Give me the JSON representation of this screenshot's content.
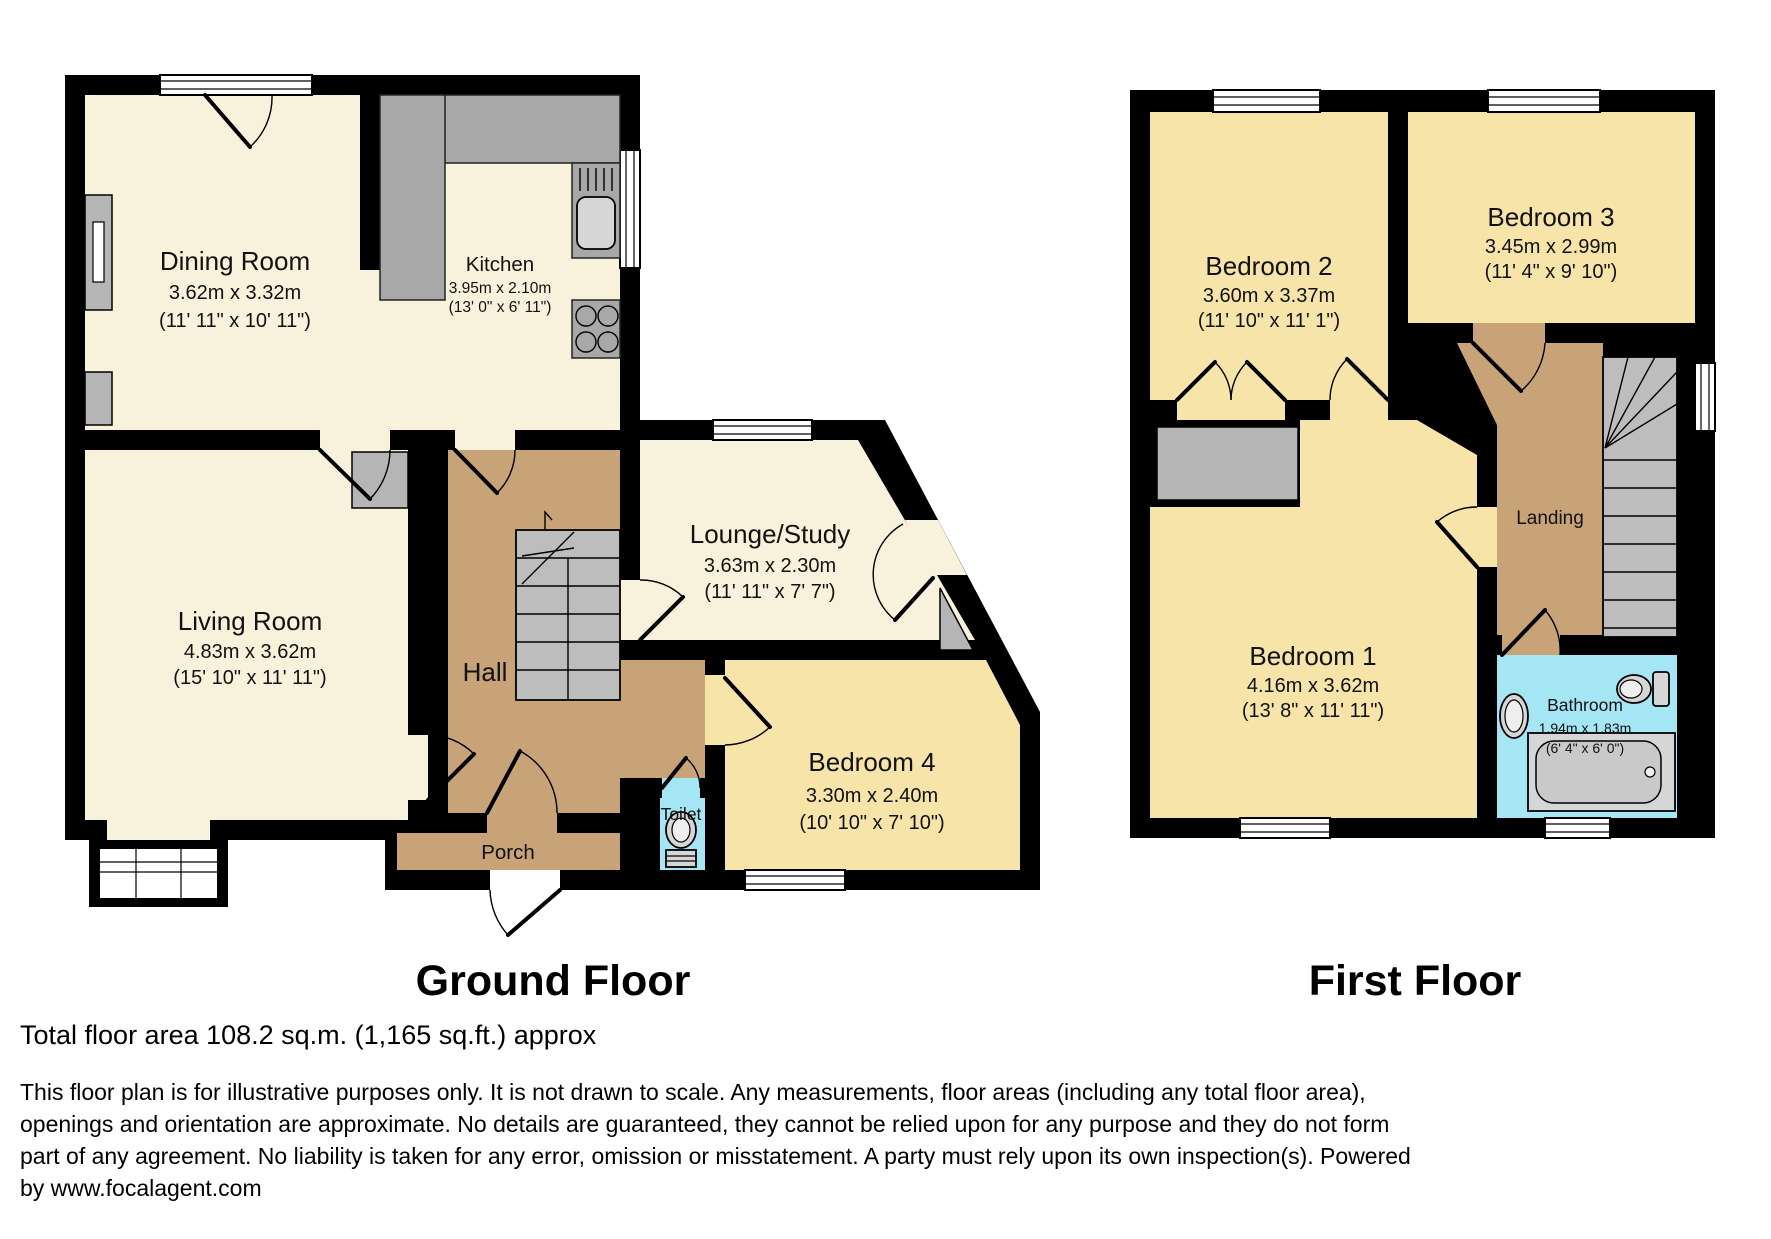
{
  "document": {
    "type": "floorplan"
  },
  "ground_floor": {
    "label": "Ground Floor",
    "rooms": {
      "dining": {
        "name": "Dining Room",
        "metric": "3.62m x 3.32m",
        "imperial": "(11' 11\" x 10' 11\")"
      },
      "kitchen": {
        "name": "Kitchen",
        "metric": "3.95m x 2.10m",
        "imperial": "(13' 0\" x 6' 11\")"
      },
      "living": {
        "name": "Living Room",
        "metric": "4.83m x 3.62m",
        "imperial": "(15' 10\" x 11' 11\")"
      },
      "hall": {
        "name": "Hall"
      },
      "lounge": {
        "name": "Lounge/Study",
        "metric": "3.63m x 2.30m",
        "imperial": "(11' 11\" x 7' 7\")"
      },
      "bedroom4": {
        "name": "Bedroom 4",
        "metric": "3.30m x 2.40m",
        "imperial": "(10' 10\" x 7' 10\")"
      },
      "toilet": {
        "name": "Toilet"
      },
      "porch": {
        "name": "Porch"
      }
    }
  },
  "first_floor": {
    "label": "First Floor",
    "rooms": {
      "bedroom2": {
        "name": "Bedroom 2",
        "metric": "3.60m x 3.37m",
        "imperial": "(11' 10\" x 11' 1\")"
      },
      "bedroom3": {
        "name": "Bedroom 3",
        "metric": "3.45m x 2.99m",
        "imperial": "(11' 4\" x 9' 10\")"
      },
      "bedroom1": {
        "name": "Bedroom 1",
        "metric": "4.16m x 3.62m",
        "imperial": "(13' 8\" x 11' 11\")"
      },
      "landing": {
        "name": "Landing"
      },
      "bathroom": {
        "name": "Bathroom",
        "metric": "1.94m x 1.83m",
        "imperial": "(6' 4\" x 6' 0\")"
      }
    }
  },
  "footer": {
    "total_area": "Total floor area 108.2 sq.m. (1,165 sq.ft.) approx",
    "disclaimer_lines": [
      "This floor plan is for illustrative purposes only. It is not drawn to scale. Any measurements, floor areas (including any total floor area),",
      "openings and orientation are approximate. No details are guaranteed, they cannot be relied upon for any purpose and they do not form",
      "part of any agreement. No liability is taken for any error, omission or misstatement. A party must rely upon its own inspection(s). Powered",
      "by www.focalagent.com"
    ]
  },
  "colors": {
    "wall": "#000000",
    "reception_floor": "#f8f1db",
    "bedroom_floor": "#f6e4a9",
    "hall_floor": "#c7a377",
    "wet_room_floor": "#a5e6f5",
    "fixture_gray": "#a8a8a8",
    "stair_gray": "#bdbdbd"
  }
}
